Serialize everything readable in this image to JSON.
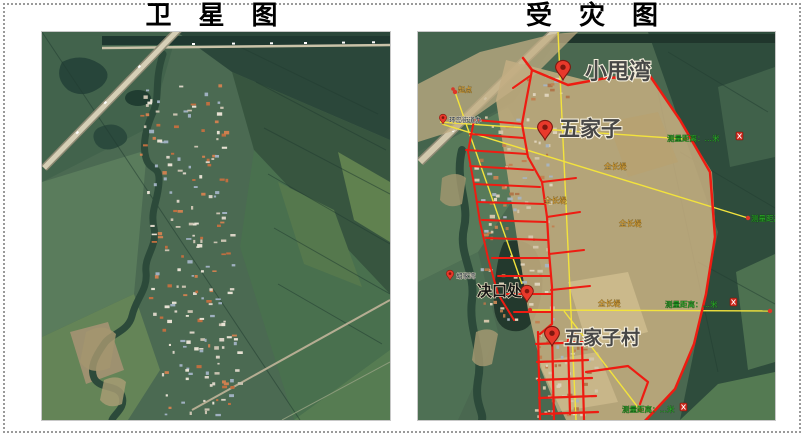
{
  "figure": {
    "left_panel": {
      "title": "卫 星 图"
    },
    "right_panel": {
      "title": "受 灾 图"
    }
  },
  "right_map": {
    "pins": [
      {
        "label": "小甩湾"
      },
      {
        "label": "五家子"
      },
      {
        "label": "决口处"
      },
      {
        "label": "五家子村"
      },
      {
        "label": "环岛街道办"
      },
      {
        "label": "胡家湾"
      }
    ],
    "measure_labels": [
      {
        "text": "测量距离：…米"
      },
      {
        "text": "测量距离：…米"
      },
      {
        "text": "测量距离：…米"
      },
      {
        "text": "测量距离：…米"
      }
    ],
    "path_labels": [
      {
        "text": "起点"
      },
      {
        "text": "全长堤"
      },
      {
        "text": "全长堤"
      },
      {
        "text": "全长堤"
      },
      {
        "text": "全长堤"
      }
    ],
    "colors": {
      "flood_area": "#c3ac7e",
      "damage_outline_red": "#ee1c12",
      "measure_line_yellow": "#f3e33c",
      "measure_text_green": "#2fae2c",
      "pin_red": "#e8392b"
    }
  }
}
